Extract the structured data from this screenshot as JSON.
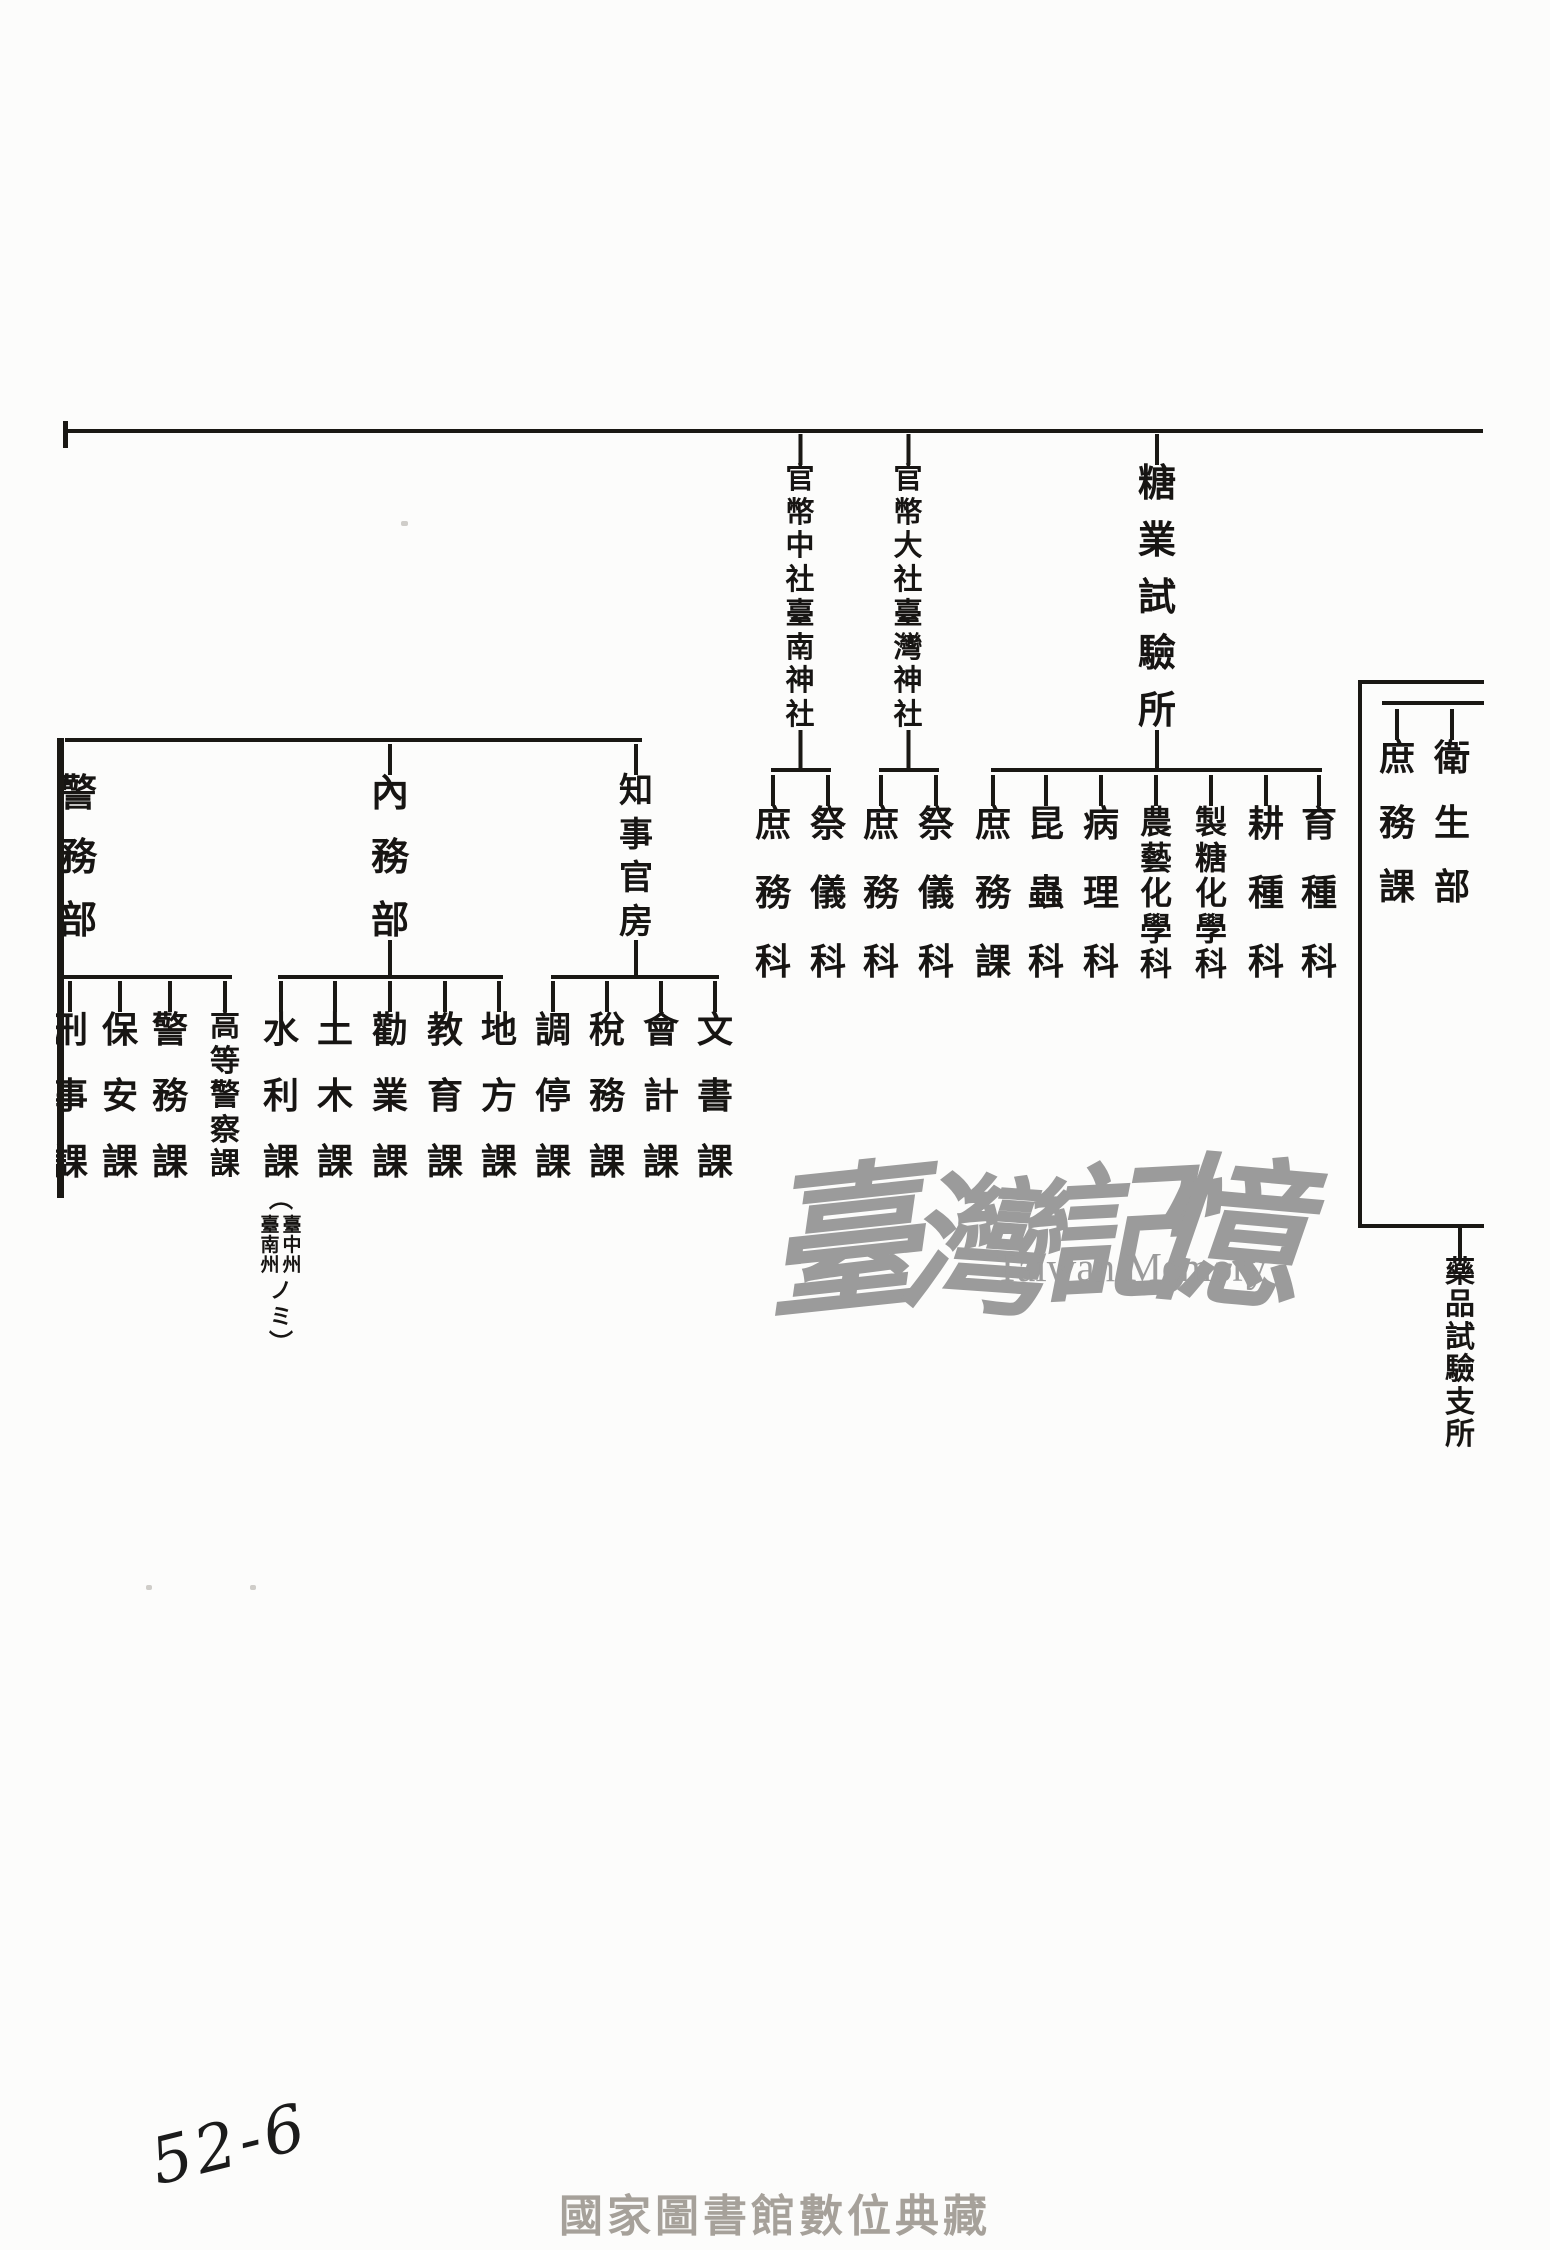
{
  "document": {
    "watermark": {
      "cjk": "臺灣記憶",
      "latin": "Taiwan Memory"
    },
    "watermark_chars": [
      "臺",
      "灣",
      "記",
      "憶"
    ],
    "footer_caption": "國家圖書館數位典藏",
    "handwritten_page_no": "52-6",
    "ink_color": "#1a1814",
    "watermark_color": "#9b9b9b",
    "footer_color": "#a6a19a"
  },
  "org": {
    "top_level_units": [
      {
        "name": "官幣中社臺南神社",
        "children": [
          "庶務科",
          "祭儀科"
        ]
      },
      {
        "name": "官幣大社臺灣神社",
        "children": [
          "庶務科",
          "祭儀科"
        ]
      },
      {
        "name": "糖業試驗所",
        "children": [
          "庶務課",
          "昆蟲科",
          "病理科",
          "農藝化學科",
          "製糖化學科",
          "耕種科",
          "育種科"
        ]
      }
    ],
    "department_units": [
      {
        "name": "警務部",
        "children": [
          "刑事課",
          "保安課",
          "警務課",
          "高等警察課"
        ]
      },
      {
        "name": "內務部",
        "children": [
          "水利課",
          "土木課",
          "勸業課",
          "教育課",
          "地方課"
        ],
        "suiri_note": {
          "open": "︵",
          "col_right": "臺中州",
          "col_left": "臺南州",
          "tail": "ノミ",
          "close": "︶"
        }
      },
      {
        "name": "知事官房",
        "children": [
          "調停課",
          "稅務課",
          "會計課",
          "文書課"
        ]
      }
    ],
    "health_unit": {
      "name": "衛生部",
      "sections": [
        "庶務課"
      ],
      "branch_office": "藥品試驗支所"
    }
  }
}
